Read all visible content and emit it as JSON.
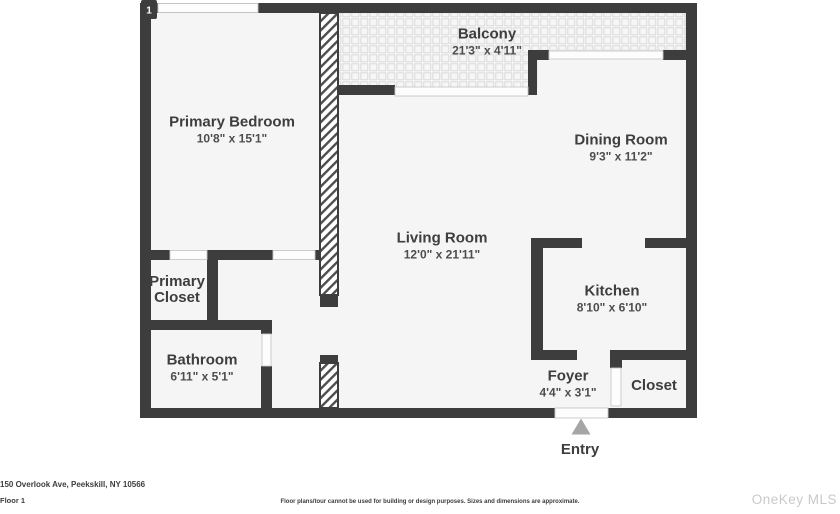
{
  "plan": {
    "marker": "1",
    "rooms": {
      "primary_bedroom": {
        "name": "Primary Bedroom",
        "dims": "10'8\" x 15'1\""
      },
      "balcony": {
        "name": "Balcony",
        "dims": "21'3\" x 4'11\""
      },
      "dining_room": {
        "name": "Dining Room",
        "dims": "9'3\" x 11'2\""
      },
      "living_room": {
        "name": "Living Room",
        "dims": "12'0\" x 21'11\""
      },
      "kitchen": {
        "name": "Kitchen",
        "dims": "8'10\" x 6'10\""
      },
      "primary_closet": {
        "name": "Primary Closet"
      },
      "bathroom": {
        "name": "Bathroom",
        "dims": "6'11\" x 5'1\""
      },
      "foyer": {
        "name": "Foyer",
        "dims": "4'4\" x 3'1\""
      },
      "closet": {
        "name": "Closet"
      }
    },
    "entry_label": "Entry"
  },
  "footer": {
    "address": "150 Overlook Ave, Peekskill, NY 10566",
    "floor": "Floor 1",
    "disclaimer": "Floor plans/tour cannot be used for building or design purposes. Sizes and dimensions are approximate.",
    "watermark": "OneKey MLS"
  },
  "colors": {
    "wall": "#3d3d3d",
    "room_fill": "#f5f5f5",
    "entry_arrow": "#a6a6a6",
    "text": "#3e3e3e",
    "watermark": "#c9c9c9"
  }
}
